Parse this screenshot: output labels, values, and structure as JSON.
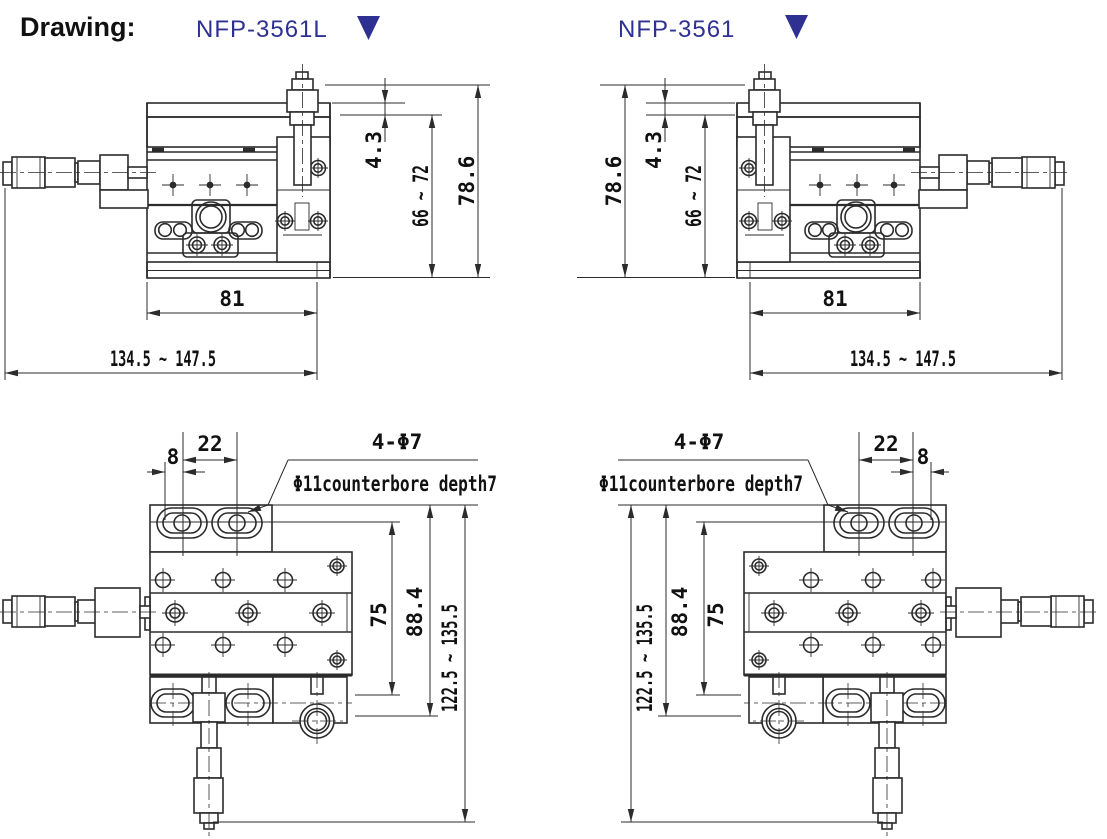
{
  "header": {
    "title": "Drawing:"
  },
  "models": [
    {
      "label": "NFP-3561L"
    },
    {
      "label": "NFP-3561"
    }
  ],
  "colors": {
    "accent": "#2e3192",
    "line": "#2b2b2b",
    "text": "#111111"
  },
  "views": {
    "side": {
      "dims": {
        "offset_top": "4.3",
        "travel_height": "66 ~ 72",
        "total_height": "78.6",
        "stage_width": "81",
        "length_range": "134.5 ~ 147.5"
      }
    },
    "top": {
      "dims": {
        "slot_offset": "8",
        "slot_pitch": "22",
        "holes_note": "4-Φ7",
        "counterbore_note": "Φ11counterbore depth7",
        "hole_pitch": "75",
        "body_size": "88.4",
        "height_range": "122.5 ~ 135.5"
      }
    }
  }
}
